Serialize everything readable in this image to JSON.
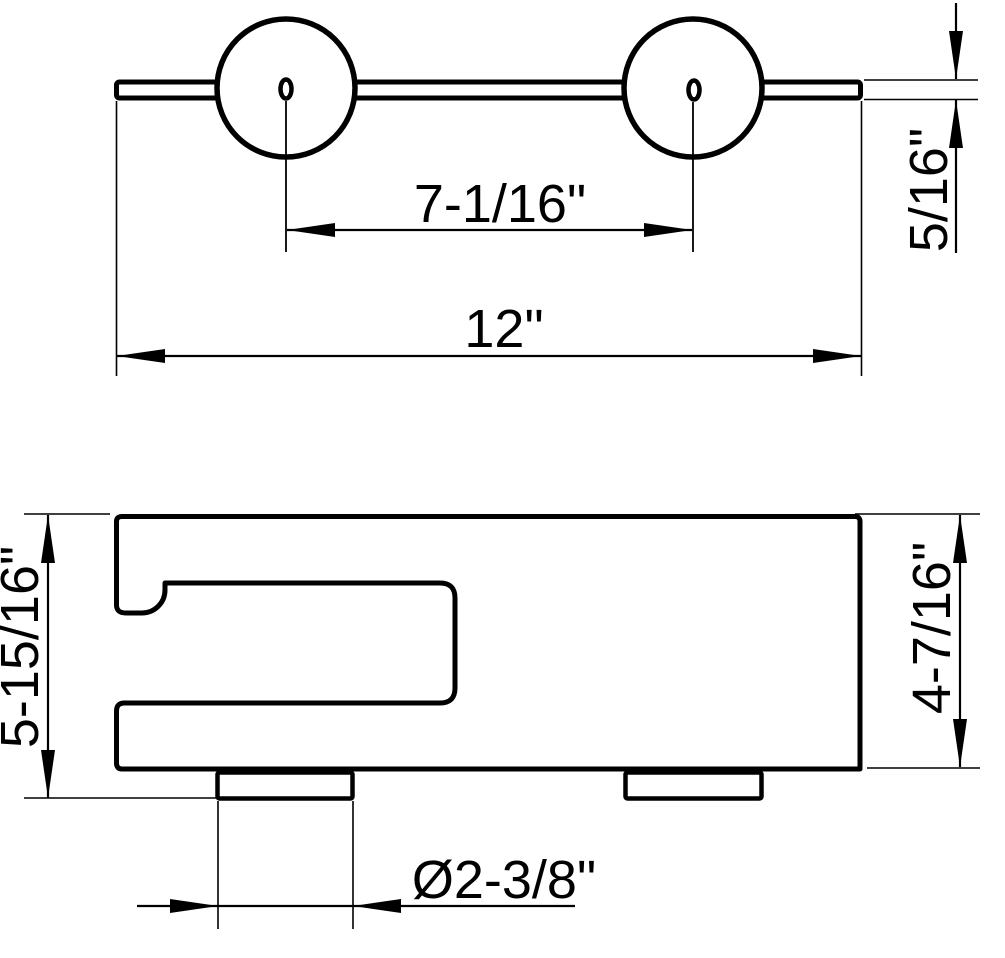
{
  "drawing": {
    "background": "#ffffff",
    "line_color": "#000000",
    "dimensions": {
      "hole_spacing": "7-1/16\"",
      "overall_width": "12\"",
      "bar_thickness": "5/16\"",
      "overall_height": "5-15/16\"",
      "body_height": "4-7/16\"",
      "post_diameter": "Ø2-3/8\""
    }
  }
}
